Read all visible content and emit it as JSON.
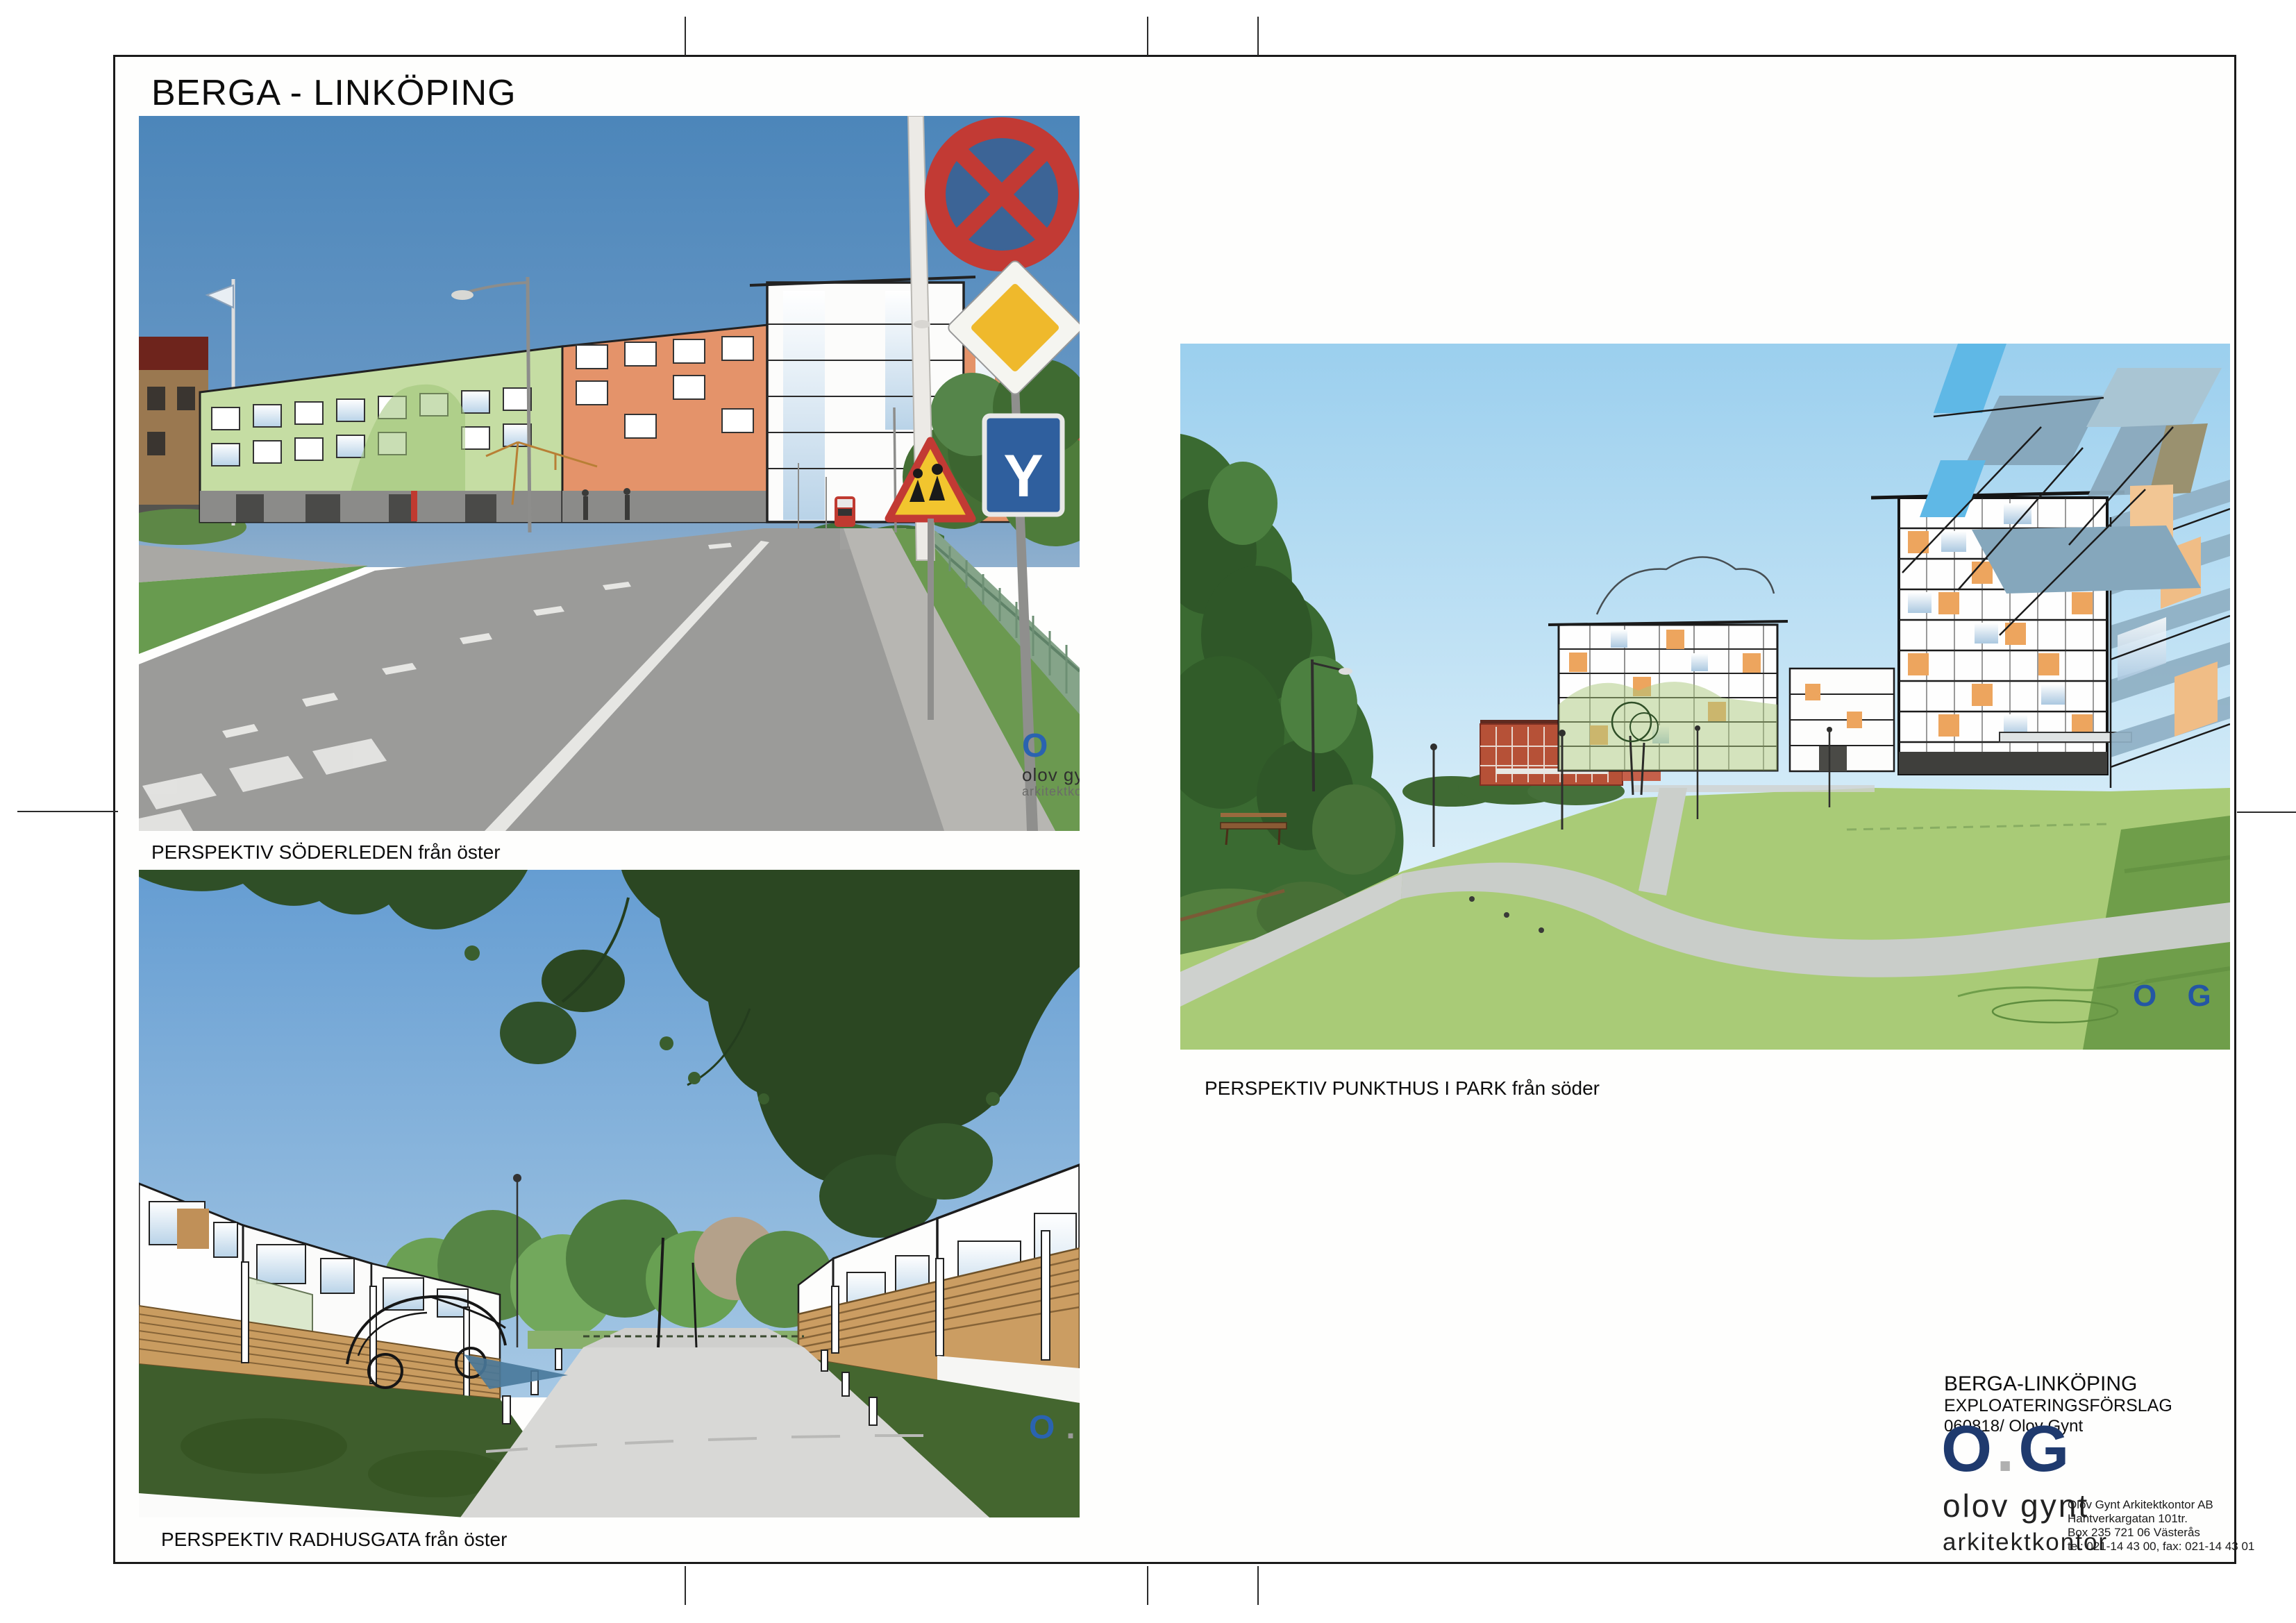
{
  "page": {
    "title": "BERGA - LINKÖPING"
  },
  "images": {
    "soderleden": {
      "caption": "PERSPEKTIV  SÖDERLEDEN från öster",
      "sign_y": "Y"
    },
    "radhusgata": {
      "caption": "PERSPEKTIV RADHUSGATA från öster"
    },
    "punkthus": {
      "caption": "PERSPEKTIV  PUNKTHUS I PARK från söder"
    }
  },
  "watermark": {
    "o": "O",
    "g": "G",
    "dot": ".",
    "name": "olov gynt",
    "firm": "arkitektkontor"
  },
  "project": {
    "line1": "BERGA-LINKÖPING",
    "line2": "EXPLOATERINGSFÖRSLAG",
    "line3": "060818/ Olov Gynt"
  },
  "logo": {
    "o": "O",
    "dot": ".",
    "g": "G",
    "name1": "olov gynt",
    "name2": "arkitektkontor",
    "address": [
      "Olov Gynt Arkitektkontor AB",
      "Hantverkargatan 101tr.",
      "Box 235 721 06 Västerås",
      "tel: 021-14 43 00, fax: 021-14 43 01"
    ]
  },
  "colors": {
    "logo_navy": "#1f3a6e",
    "watermark_blue": "#2a63b0",
    "facade_green": "#c5dda3",
    "facade_orange": "#e4936a",
    "sky_blue": "#4c86ba",
    "lawn_green": "#a9cb77"
  }
}
